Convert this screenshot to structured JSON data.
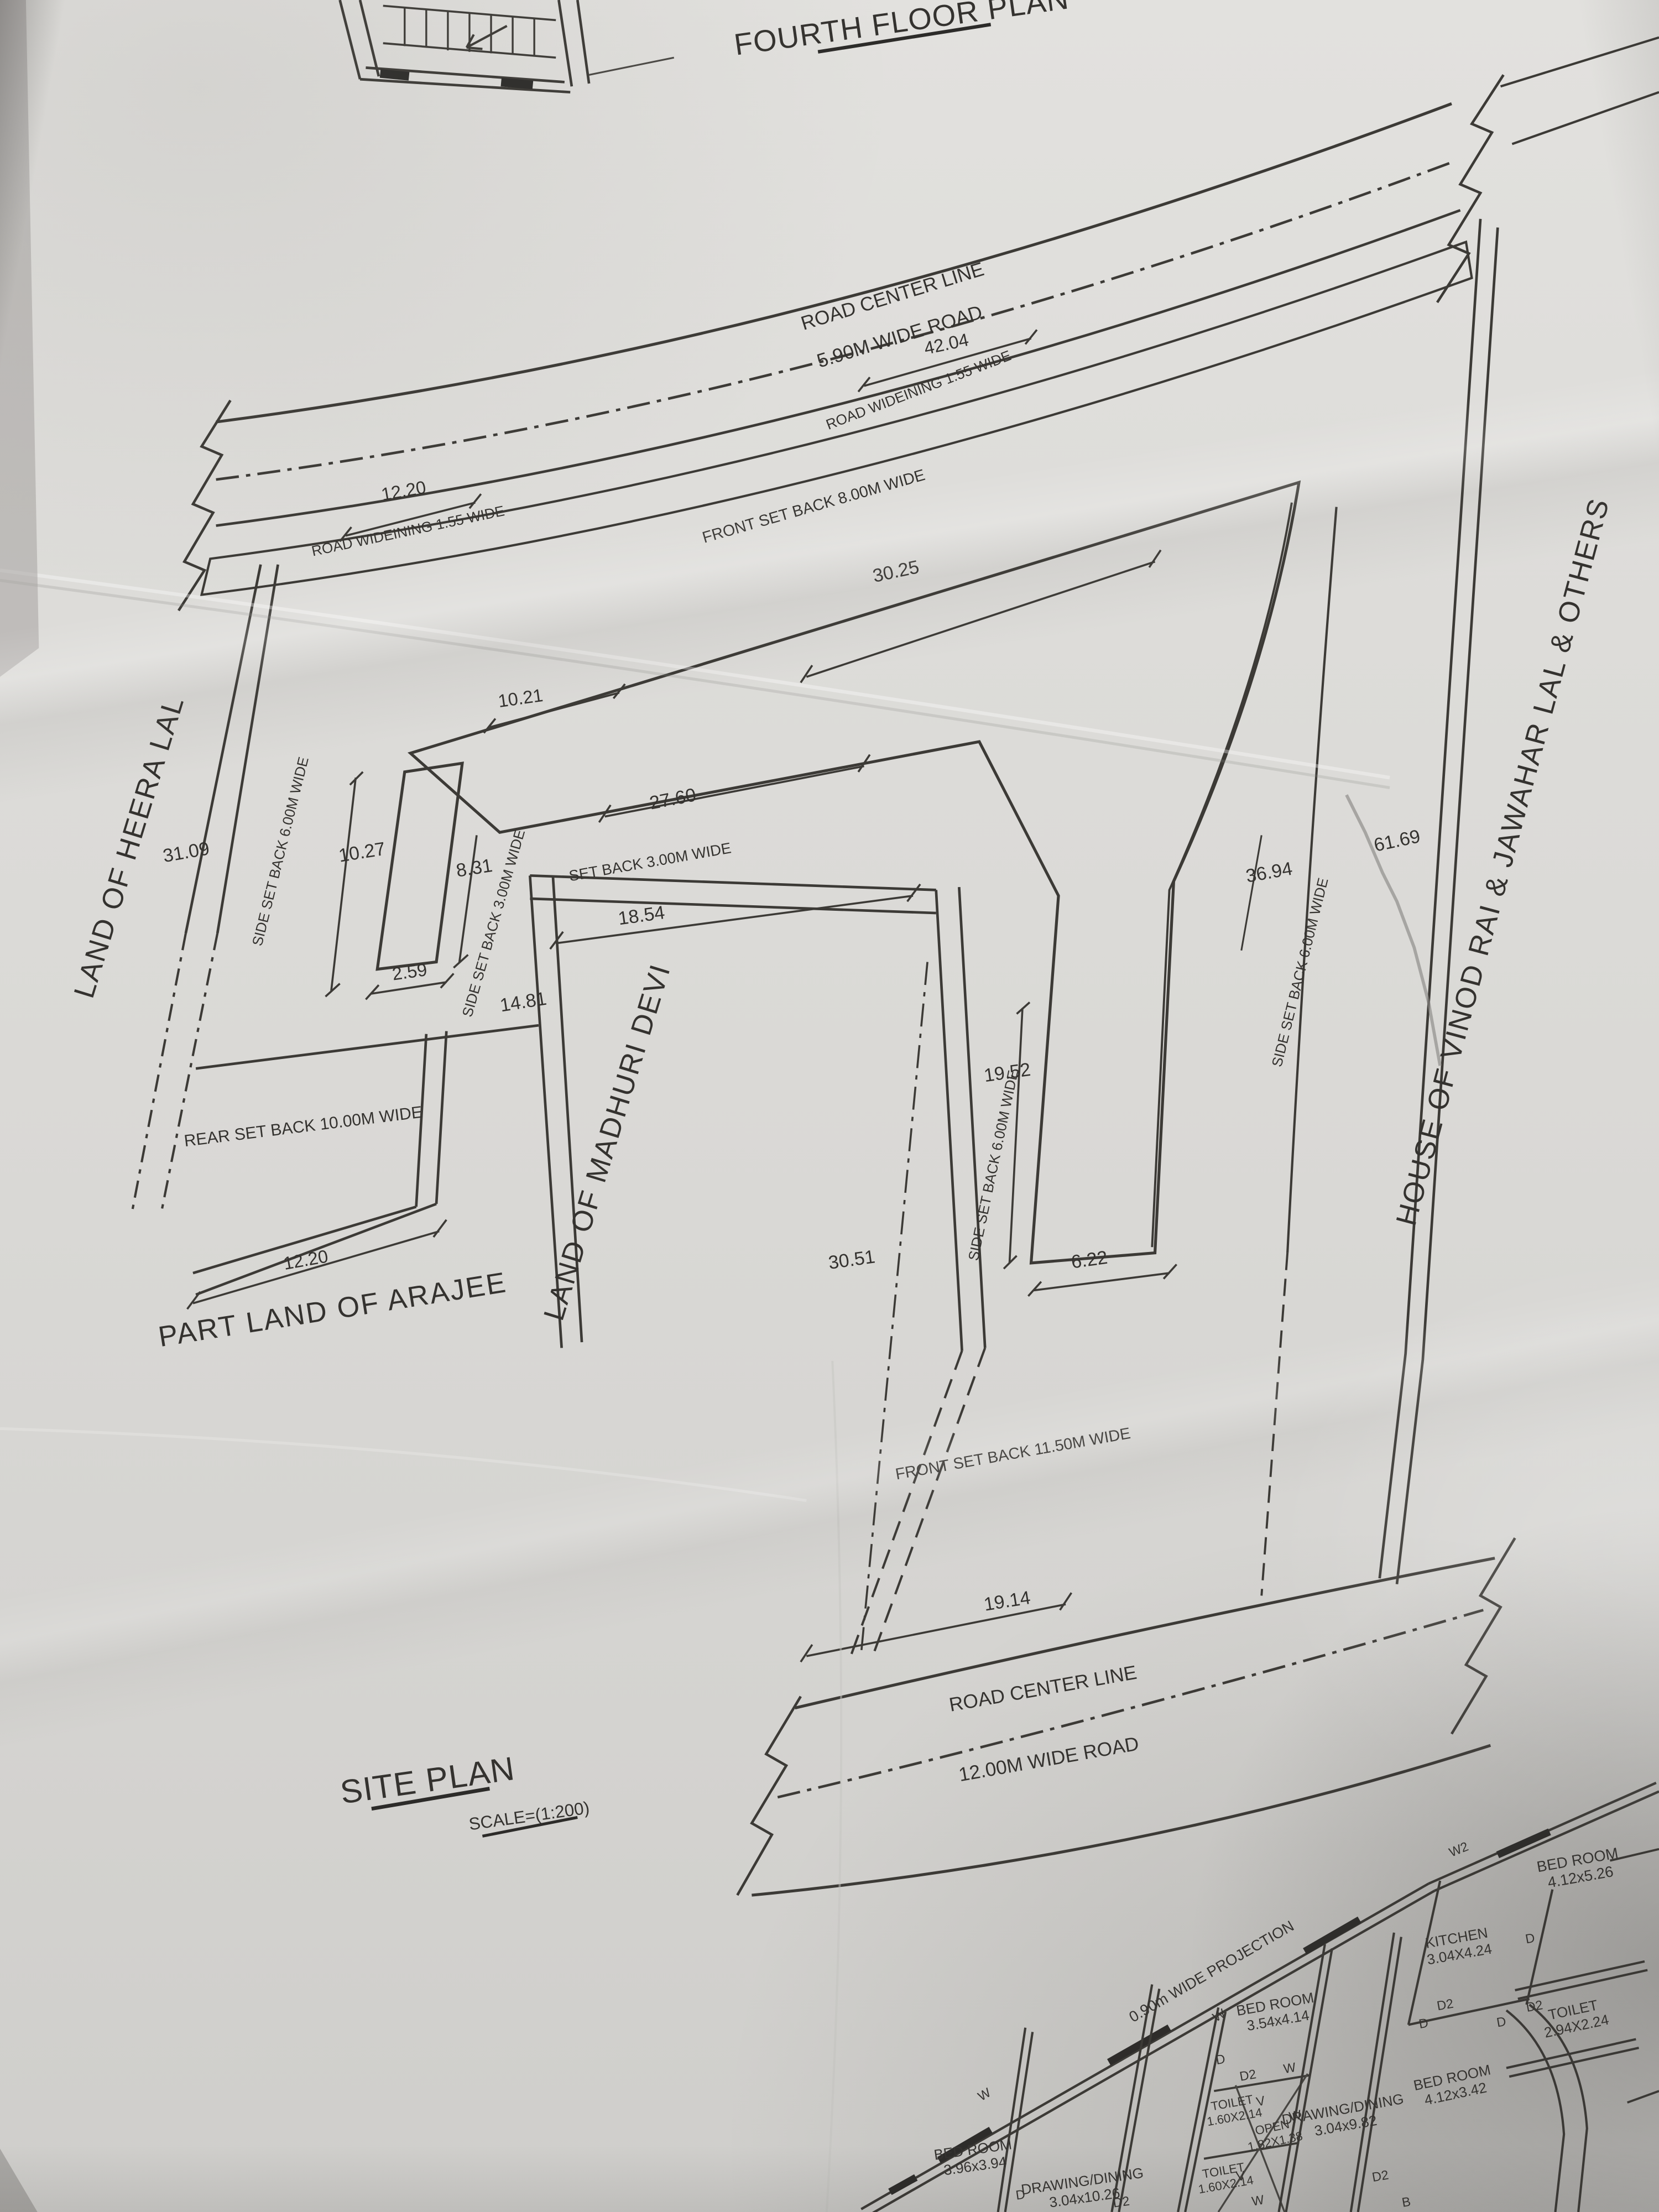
{
  "sheet": {
    "fourth_floor_title": "FOURTH FLOOR PLAN",
    "site_plan_title": "SITE PLAN",
    "scale_label": "SCALE=(1:200)"
  },
  "upper_road": {
    "center_line": "ROAD CENTER LINE",
    "width_label": "5.90M WIDE ROAD",
    "length_dim": "42.04",
    "widening_right": "ROAD WIDEINING 1.55 WIDE",
    "widening_left": "ROAD WIDEINING 1.55 WIDE",
    "edge_dim": "12.20"
  },
  "lower_road": {
    "center_line": "ROAD CENTER LINE",
    "width_label": "12.00M WIDE ROAD",
    "frontage_dim": "19.14"
  },
  "setbacks": {
    "front_upper": "FRONT SET BACK 8.00M WIDE",
    "front_lower": "FRONT SET BACK 11.50M WIDE",
    "rear": "REAR SET BACK 10.00M WIDE",
    "side_left": "SIDE SET BACK 6.00M WIDE",
    "side_left_3m": "SIDE SET BACK 3.00M WIDE",
    "inner_3m": "SET BACK 3.00M WIDE",
    "side_middle": "SIDE SET BACK 6.00M WIDE",
    "side_right": "SIDE SET BACK 6.00M WIDE"
  },
  "dims": {
    "d30_25": "30.25",
    "d10_21": "10.21",
    "d27_60": "27.60",
    "d18_54": "18.54",
    "d10_27": "10.27",
    "d8_31": "8.31",
    "d2_59": "2.59",
    "d14_81": "14.81",
    "d31_09": "31.09",
    "d36_94": "36.94",
    "d61_69": "61.69",
    "d19_52": "19.52",
    "d6_22": "6.22",
    "d30_51": "30.51",
    "d12_20_rear": "12.20"
  },
  "neighbours": {
    "left": "LAND OF HEERA LAL",
    "middle": "LAND OF MADHURI DEVI",
    "rear": "PART LAND OF ARAJEE",
    "right": "HOUSE OF VINOD RAI & JAWAHAR LAL & OTHERS"
  },
  "ground_floor": {
    "projection": "0.90m WIDE PROJECTION",
    "rooms": [
      {
        "name": "BED ROOM",
        "size": "4.12x5.26"
      },
      {
        "name": "KITCHEN",
        "size": "3.04X4.24"
      },
      {
        "name": "TOILET",
        "size": "2.94X2.24"
      },
      {
        "name": "BED ROOM",
        "size": "3.54x4.14"
      },
      {
        "name": "TOILET",
        "size": "1.60X2.14"
      },
      {
        "name": "OPEN",
        "size": "1.82X1.38"
      },
      {
        "name": "DRAWING/DINING",
        "size": "3.04x9.82"
      },
      {
        "name": "BED ROOM",
        "size": "4.12x3.42"
      },
      {
        "name": "TOILET",
        "size": "1.60X2.14"
      },
      {
        "name": "BED ROOM",
        "size": "3.96x3.94"
      },
      {
        "name": "DRAWING/DINING",
        "size": "3.04x10.26"
      }
    ],
    "markers": {
      "w2": "W2",
      "d": "D",
      "d2": "D2",
      "w": "W",
      "v": "V",
      "b": "B"
    }
  }
}
